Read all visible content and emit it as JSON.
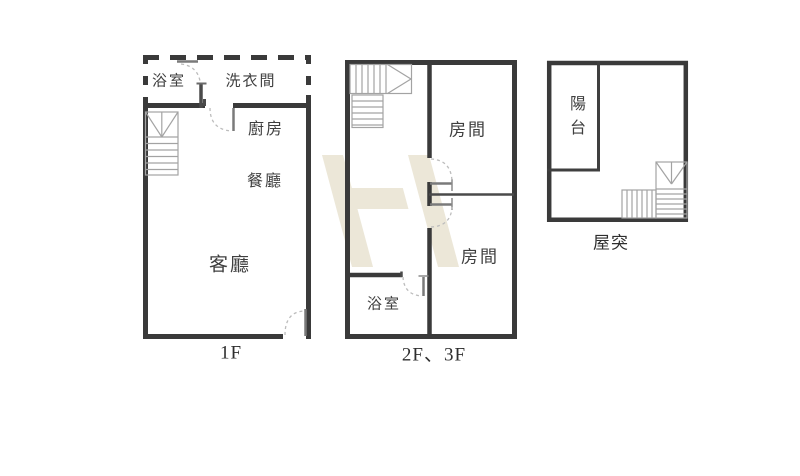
{
  "title": "apartment floor plans",
  "colors": {
    "wall": "#3a3a3a",
    "thin_wall": "#4a4a4a",
    "stair_line": "#a3a3a3",
    "door_arc": "#bcbcbc",
    "text": "#3f3f3f",
    "watermark": "#ece7d8",
    "background": "#ffffff"
  },
  "watermark": {
    "letter": "H",
    "color": "#ece7d8"
  },
  "plans": [
    {
      "id": "1f",
      "label": "1F",
      "rooms": [
        {
          "name": "bathroom",
          "label": "浴室"
        },
        {
          "name": "laundry-room",
          "label": "洗衣間"
        },
        {
          "name": "kitchen",
          "label": "廚房"
        },
        {
          "name": "dining-room",
          "label": "餐廳"
        },
        {
          "name": "living-room",
          "label": "客廳"
        }
      ]
    },
    {
      "id": "2f-3f",
      "label": "2F、3F",
      "rooms": [
        {
          "name": "bedroom-upper",
          "label": "房間"
        },
        {
          "name": "bedroom-lower",
          "label": "房間"
        },
        {
          "name": "bathroom",
          "label": "浴室"
        }
      ]
    },
    {
      "id": "rooftop",
      "label": "屋突",
      "rooms": [
        {
          "name": "balcony",
          "label": "陽台"
        }
      ]
    }
  ]
}
